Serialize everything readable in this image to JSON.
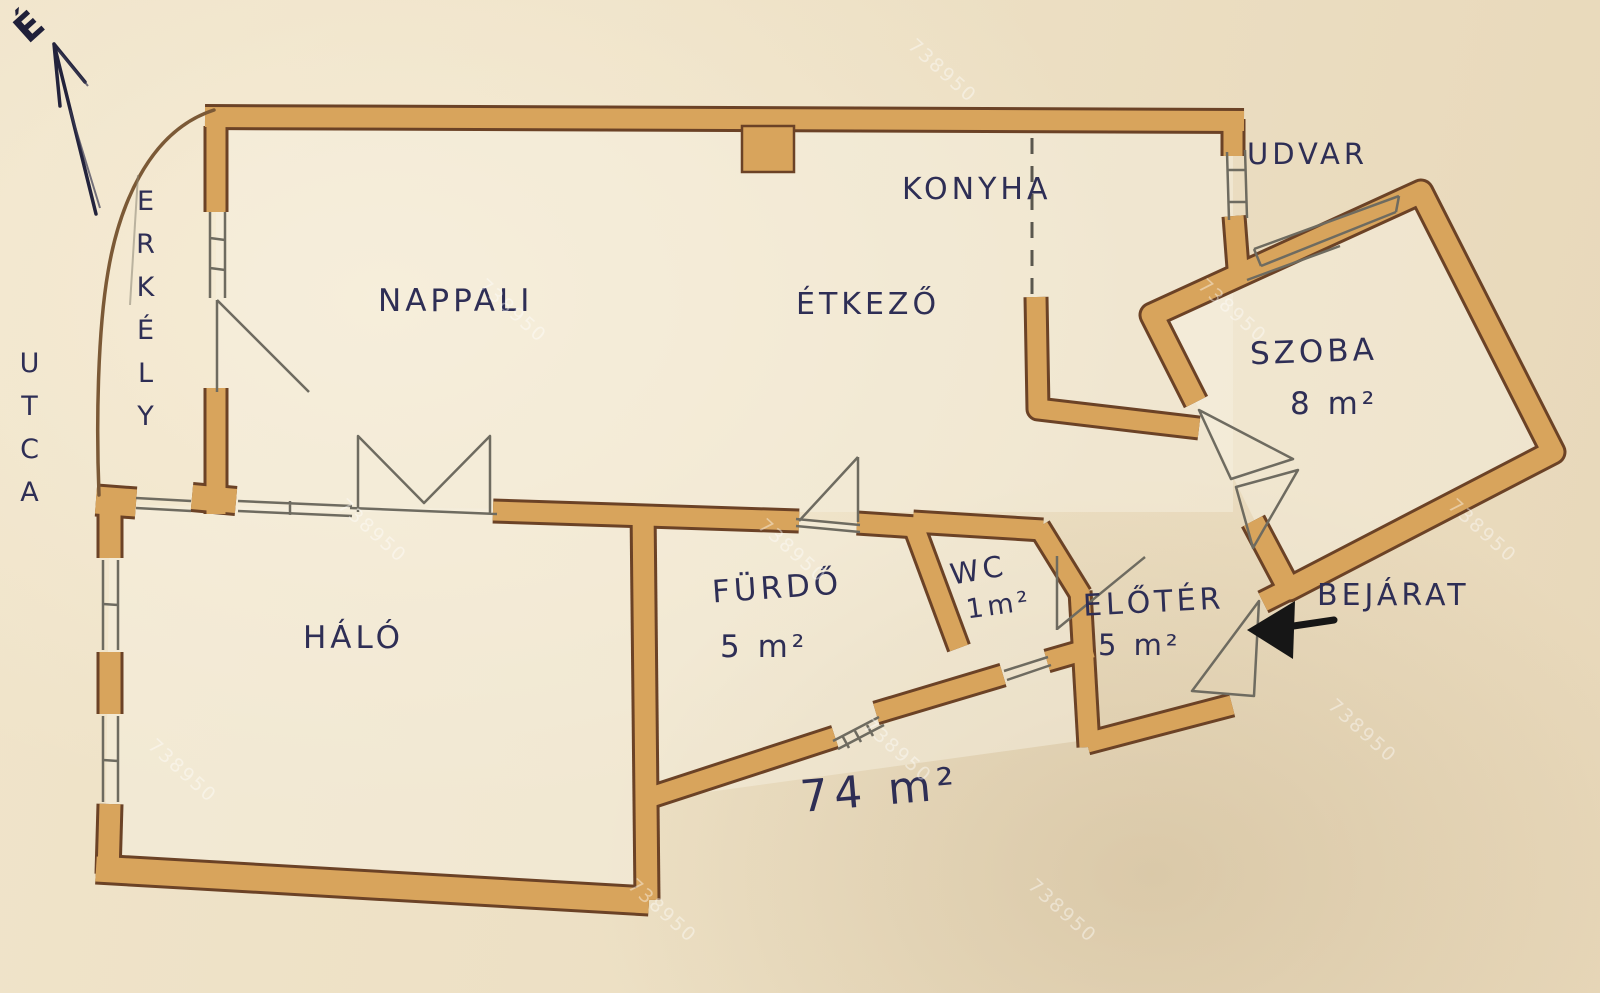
{
  "document": {
    "kind": "hand-drawn apartment floor plan photo",
    "language": "Hungarian"
  },
  "north": {
    "label": "É"
  },
  "rooms": {
    "nappali": {
      "label": "NAPPALI"
    },
    "konyha": {
      "label": "KONYHA"
    },
    "etkezo": {
      "label": "ÉTKEZŐ"
    },
    "szoba": {
      "label": "SZOBA",
      "area": "8 m²"
    },
    "halo": {
      "label": "HÁLÓ"
    },
    "furdo": {
      "label": "FÜRDŐ",
      "area": "5 m²"
    },
    "wc": {
      "label": "WC",
      "area": "1m²"
    },
    "eloter": {
      "label": "ELŐTÉR",
      "area": "5 m²"
    }
  },
  "outside": {
    "street": "UTCA",
    "balcony": "ERKÉLY",
    "courtyard": "UDVAR",
    "entrance": "BEJÁRAT"
  },
  "total_area": "74 m²",
  "watermark": "738950",
  "colors": {
    "paper": "#efe2c8",
    "wall_fill": "#d8a45c",
    "wall_edge": "#6b4226",
    "ink": "#2e2e55",
    "pencil": "#6e6b60"
  }
}
